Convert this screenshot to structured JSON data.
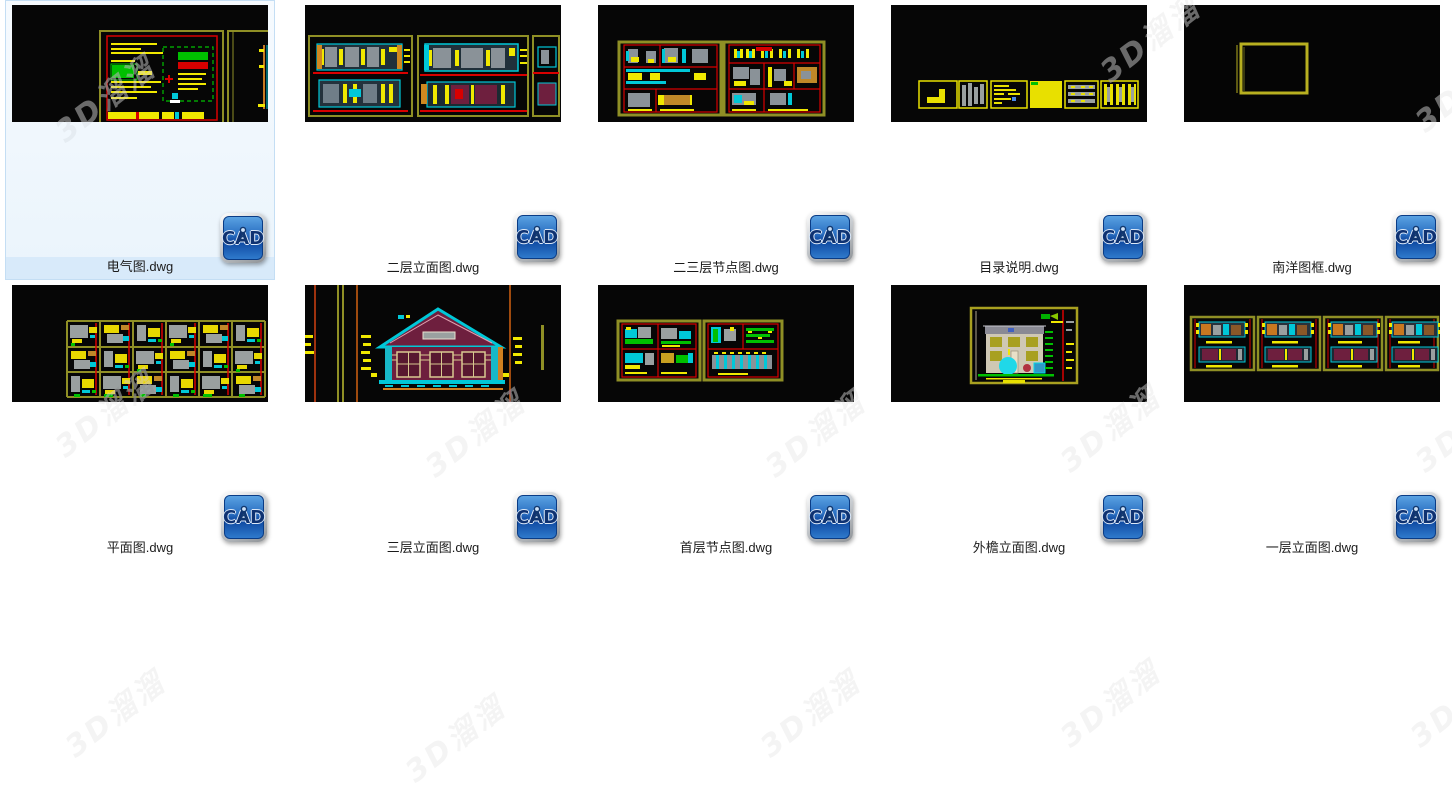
{
  "page": {
    "background": "#ffffff"
  },
  "grid": {
    "columns": 5,
    "rows": 2
  },
  "icon": {
    "label": "CAD"
  },
  "colors": {
    "selection_bg": "#eaf4fc",
    "selection_border": "#c4def4",
    "selection_label_bg": "#d8eafa",
    "thumbnail_bg": "#060606",
    "icon_blue": "#2a6fc2",
    "cad_olive": "#8f8f25",
    "cad_red": "#d80000",
    "cad_yellow": "#f0e800",
    "cad_cyan": "#00c8d8",
    "cad_green": "#00c000",
    "cad_maroon": "#6e1f3e"
  },
  "files": [
    {
      "name": "电气图.dwg",
      "selected": true,
      "thumb": "electrical"
    },
    {
      "name": "二层立面图.dwg",
      "selected": false,
      "thumb": "elevation2"
    },
    {
      "name": "二三层节点图.dwg",
      "selected": false,
      "thumb": "nodes23"
    },
    {
      "name": "目录说明.dwg",
      "selected": false,
      "thumb": "catalog"
    },
    {
      "name": "南洋图框.dwg",
      "selected": false,
      "thumb": "frame"
    },
    {
      "name": "平面图.dwg",
      "selected": false,
      "thumb": "plan"
    },
    {
      "name": "三层立面图.dwg",
      "selected": false,
      "thumb": "elevation3"
    },
    {
      "name": "首层节点图.dwg",
      "selected": false,
      "thumb": "nodes1"
    },
    {
      "name": "外檐立面图.dwg",
      "selected": false,
      "thumb": "exterior"
    },
    {
      "name": "一层立面图.dwg",
      "selected": false,
      "thumb": "elevation1"
    }
  ],
  "watermark": {
    "text": "3D溜溜",
    "positions": [
      {
        "x": 45,
        "y": 75
      },
      {
        "x": 1090,
        "y": 15
      },
      {
        "x": 1405,
        "y": 65
      },
      {
        "x": 45,
        "y": 390
      },
      {
        "x": 415,
        "y": 410
      },
      {
        "x": 755,
        "y": 410
      },
      {
        "x": 1050,
        "y": 405
      },
      {
        "x": 1405,
        "y": 405
      },
      {
        "x": 55,
        "y": 690
      },
      {
        "x": 395,
        "y": 715
      },
      {
        "x": 750,
        "y": 690
      },
      {
        "x": 1050,
        "y": 680
      },
      {
        "x": 1400,
        "y": 680
      }
    ]
  }
}
